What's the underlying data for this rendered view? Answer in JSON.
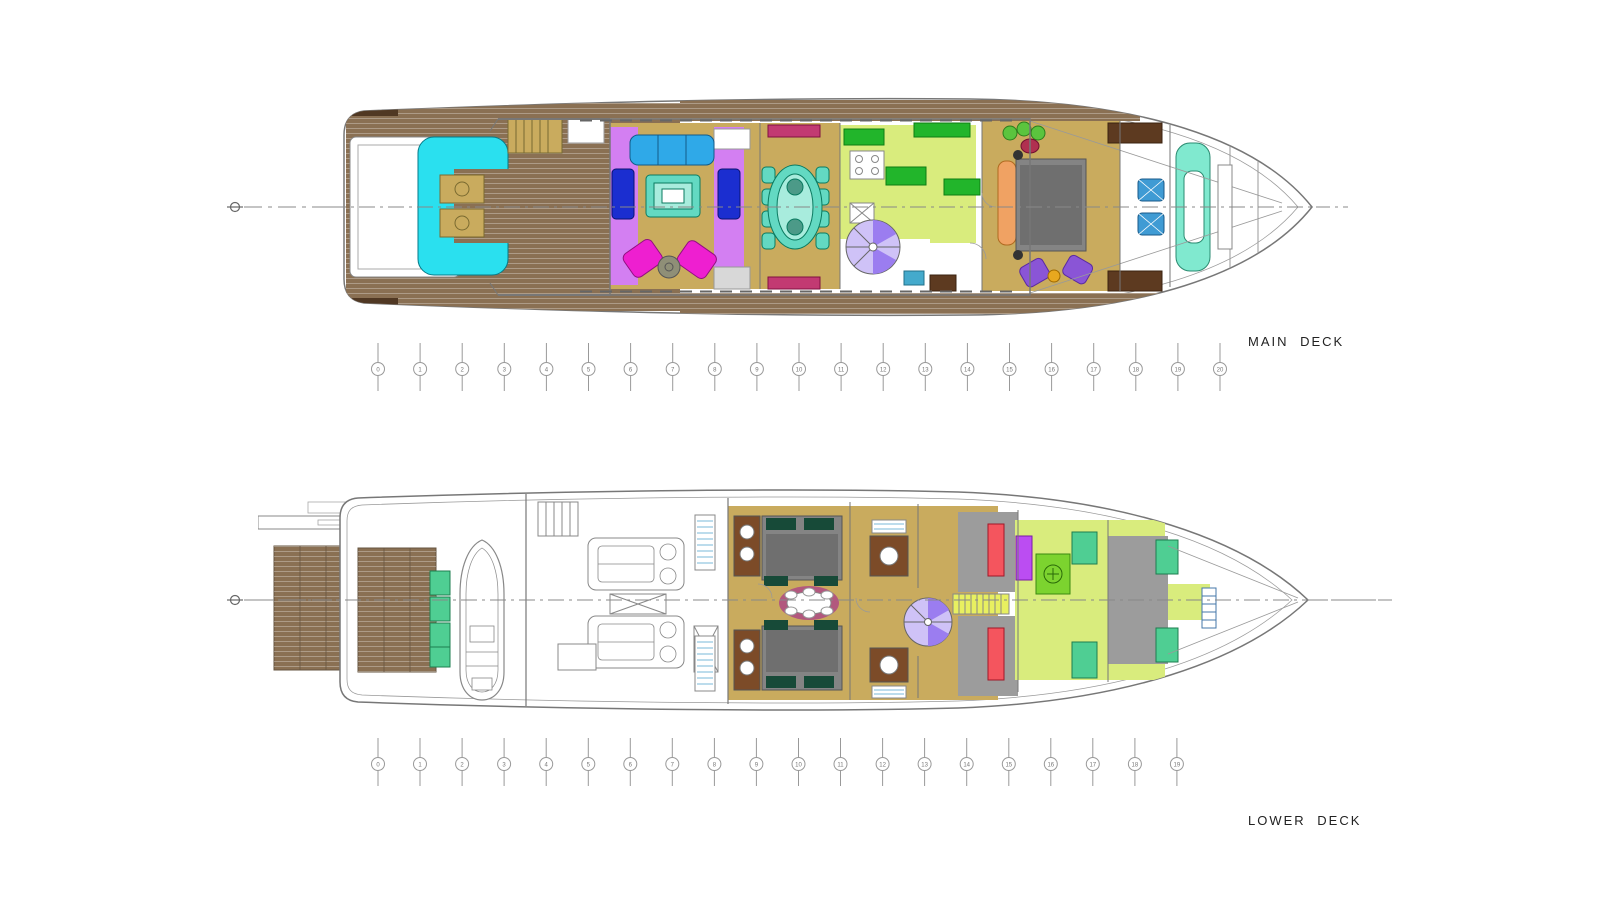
{
  "page": {
    "background": "#ffffff"
  },
  "decks": [
    {
      "id": "main-deck",
      "label": "MAIN DECK",
      "stations": [
        "0",
        "1",
        "2",
        "3",
        "4",
        "5",
        "6",
        "7",
        "8",
        "9",
        "10",
        "11",
        "12",
        "13",
        "14",
        "15",
        "16",
        "17",
        "18",
        "19",
        "20"
      ]
    },
    {
      "id": "lower-deck",
      "label": "LOWER DECK",
      "stations": [
        "0",
        "1",
        "2",
        "3",
        "4",
        "5",
        "6",
        "7",
        "8",
        "9",
        "10",
        "11",
        "12",
        "13",
        "14",
        "15",
        "16",
        "17",
        "18",
        "19"
      ]
    }
  ],
  "palette": {
    "line_gray": "#8a8a8a",
    "line_dark": "#555555",
    "teak": "#8a7053",
    "sole_tan": "#c9ab5e",
    "cyan_sofa": "#2ae0ef",
    "sky_sofa": "#2fa9e8",
    "navy_sofa": "#1b2ed0",
    "teal_table": "#63d9c2",
    "teal_light": "#a8ecdd",
    "magenta_chair": "#ee1fd0",
    "violet_carpet": "#d37ff2",
    "crimson_sideboard": "#c23a72",
    "chartreuse_floor": "#d9ec7d",
    "counter_green": "#22b52b",
    "stair_purple": "#9b7df0",
    "stair_lavender": "#cfc2f7",
    "bed_gray": "#848484",
    "duvet_gray": "#6f6f6f",
    "orange_sofa": "#f0a263",
    "wood_brown": "#5d3a20",
    "aqua_console": "#80e9cf",
    "helm_blue": "#3f9bd4",
    "plum_rug": "#b2587e",
    "mint_seat": "#4fce93",
    "coral_bunk": "#f4555e",
    "pillow_green": "#174a38",
    "stripe_blue": "#7ab8d8",
    "locker_purple": "#bb4df2",
    "washer_green": "#7cd32f",
    "bath_brown": "#7c4b28",
    "accent_red": "#b03050",
    "gold_table": "#e8a81f",
    "plant_green": "#5bc43e",
    "gray_floor": "#9c9c9c",
    "tread_yellow": "#e8f060",
    "fixture_blue": "#44aacc"
  }
}
